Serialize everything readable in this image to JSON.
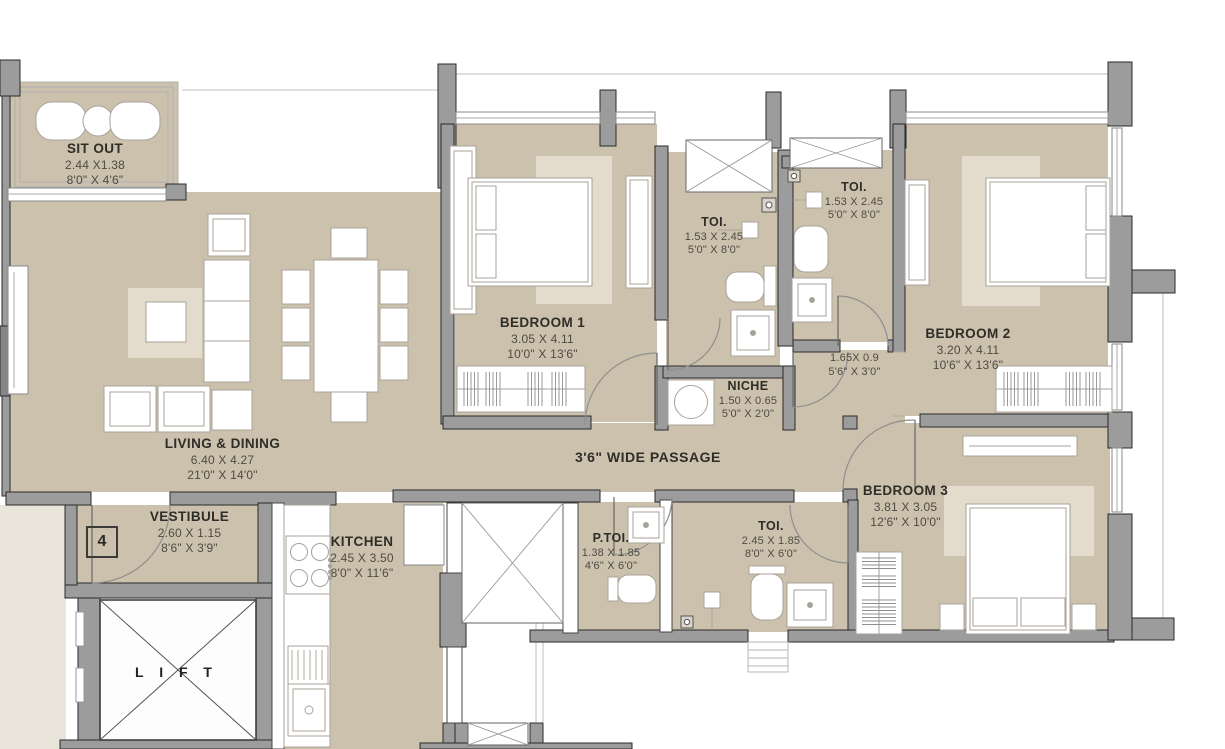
{
  "plan": {
    "unit_number": "4",
    "wide_passage_label": "3'6\" WIDE PASSAGE",
    "lift_label": "L I F T",
    "colors": {
      "floor": "#ccc1ac",
      "rug": "#e3dccd",
      "wall": "#9c9c9c",
      "outside": "#eae5da",
      "text_dark": "#2e2d28",
      "text_dim": "#4e4b44"
    },
    "rooms": {
      "sit_out": {
        "name": "SIT OUT",
        "metric": "2.44 X1.38",
        "imperial": "8'0\" X 4'6\""
      },
      "living_dining": {
        "name": "LIVING & DINING",
        "metric": "6.40 X 4.27",
        "imperial": "21'0\" X 14'0\""
      },
      "bedroom1": {
        "name": "BEDROOM 1",
        "metric": "3.05 X 4.11",
        "imperial": "10'0\" X 13'6\""
      },
      "toilet1": {
        "name": "TOI.",
        "metric": "1.53 X 2.45",
        "imperial": "5'0\" X 8'0\""
      },
      "toilet2": {
        "name": "TOI.",
        "metric": "1.53 X 2.45",
        "imperial": "5'0\" X 8'0\""
      },
      "niche": {
        "name": "NICHE",
        "metric": "1.50 X 0.65",
        "imperial": "5'0\" X 2'0\""
      },
      "dress_passage": {
        "name": "",
        "metric": "1.65X 0.9",
        "imperial": "5'6\" X 3'0\""
      },
      "bedroom2": {
        "name": "BEDROOM 2",
        "metric": "3.20 X 4.11",
        "imperial": "10'6\" X 13'6\""
      },
      "bedroom3": {
        "name": "BEDROOM 3",
        "metric": "3.81 X 3.05",
        "imperial": "12'6\" X 10'0\""
      },
      "powder_toilet": {
        "name": "P.TOI.",
        "metric": "1.38 X 1.85",
        "imperial": "4'6\" X 6'0\""
      },
      "toilet3": {
        "name": "TOI.",
        "metric": "2.45 X 1.85",
        "imperial": "8'0\" X 6'0\""
      },
      "vestibule": {
        "name": "VESTIBULE",
        "metric": "2.60 X 1.15",
        "imperial": "8'6\" X 3'9\""
      },
      "kitchen": {
        "name": "KITCHEN",
        "metric": "2.45 X 3.50",
        "imperial": "8'0\" X 11'6\""
      }
    }
  }
}
